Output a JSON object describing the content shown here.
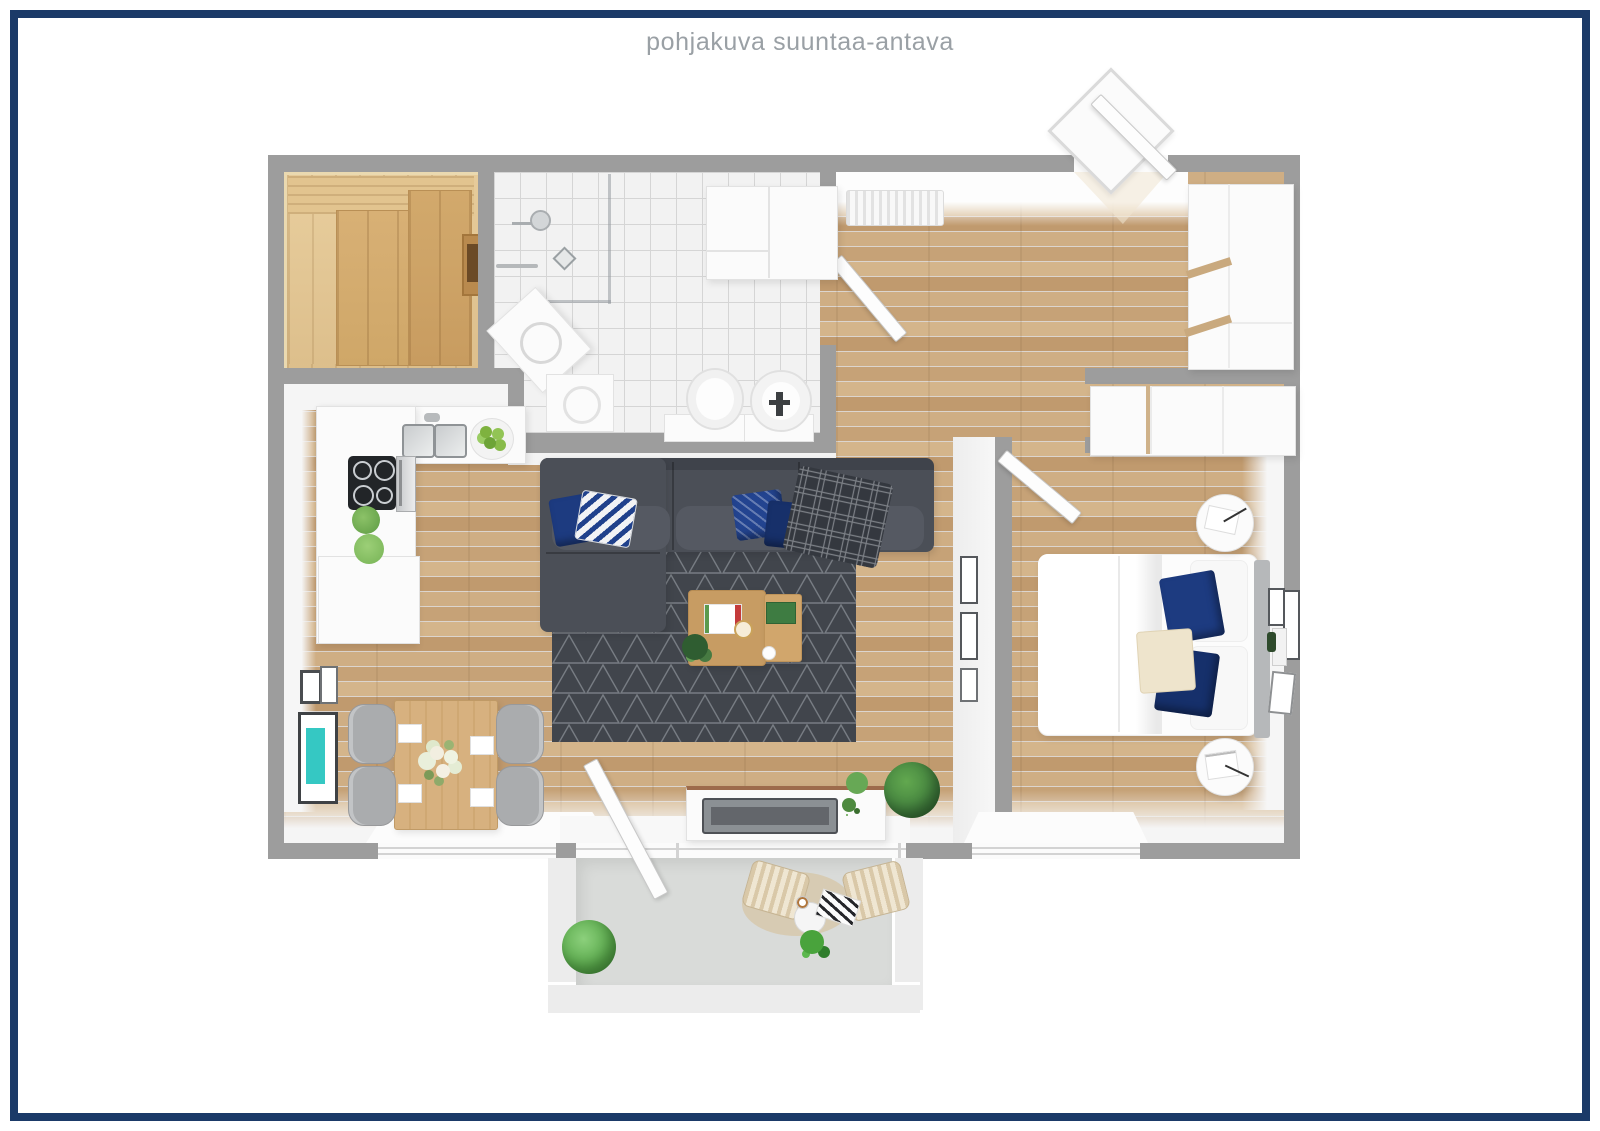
{
  "title": "pohjakuva suuntaa-antava",
  "colors": {
    "navy": "#1b3a68",
    "wall": "#9d9d9d",
    "wood": "#c9a77d",
    "sauna_wood": "#e0c28f",
    "sauna_bench": "#d2a96c",
    "tile": "#f2f2f2",
    "grout": "#d5d5d5",
    "counter": "#fbfbfb",
    "sofa": "#4b4f57",
    "rug": "#41454c",
    "pillow_navy": "#1d3b80",
    "teal": "#35c8c3",
    "chair_gray": "#aaacae",
    "table_wood": "#d7b17f",
    "coffee_wood": "#c79c63",
    "balcony_floor": "#d9dbd9",
    "headboard": "#b6b8ba",
    "plant_green": "#58a84a",
    "plant_dark": "#2f5d31"
  }
}
